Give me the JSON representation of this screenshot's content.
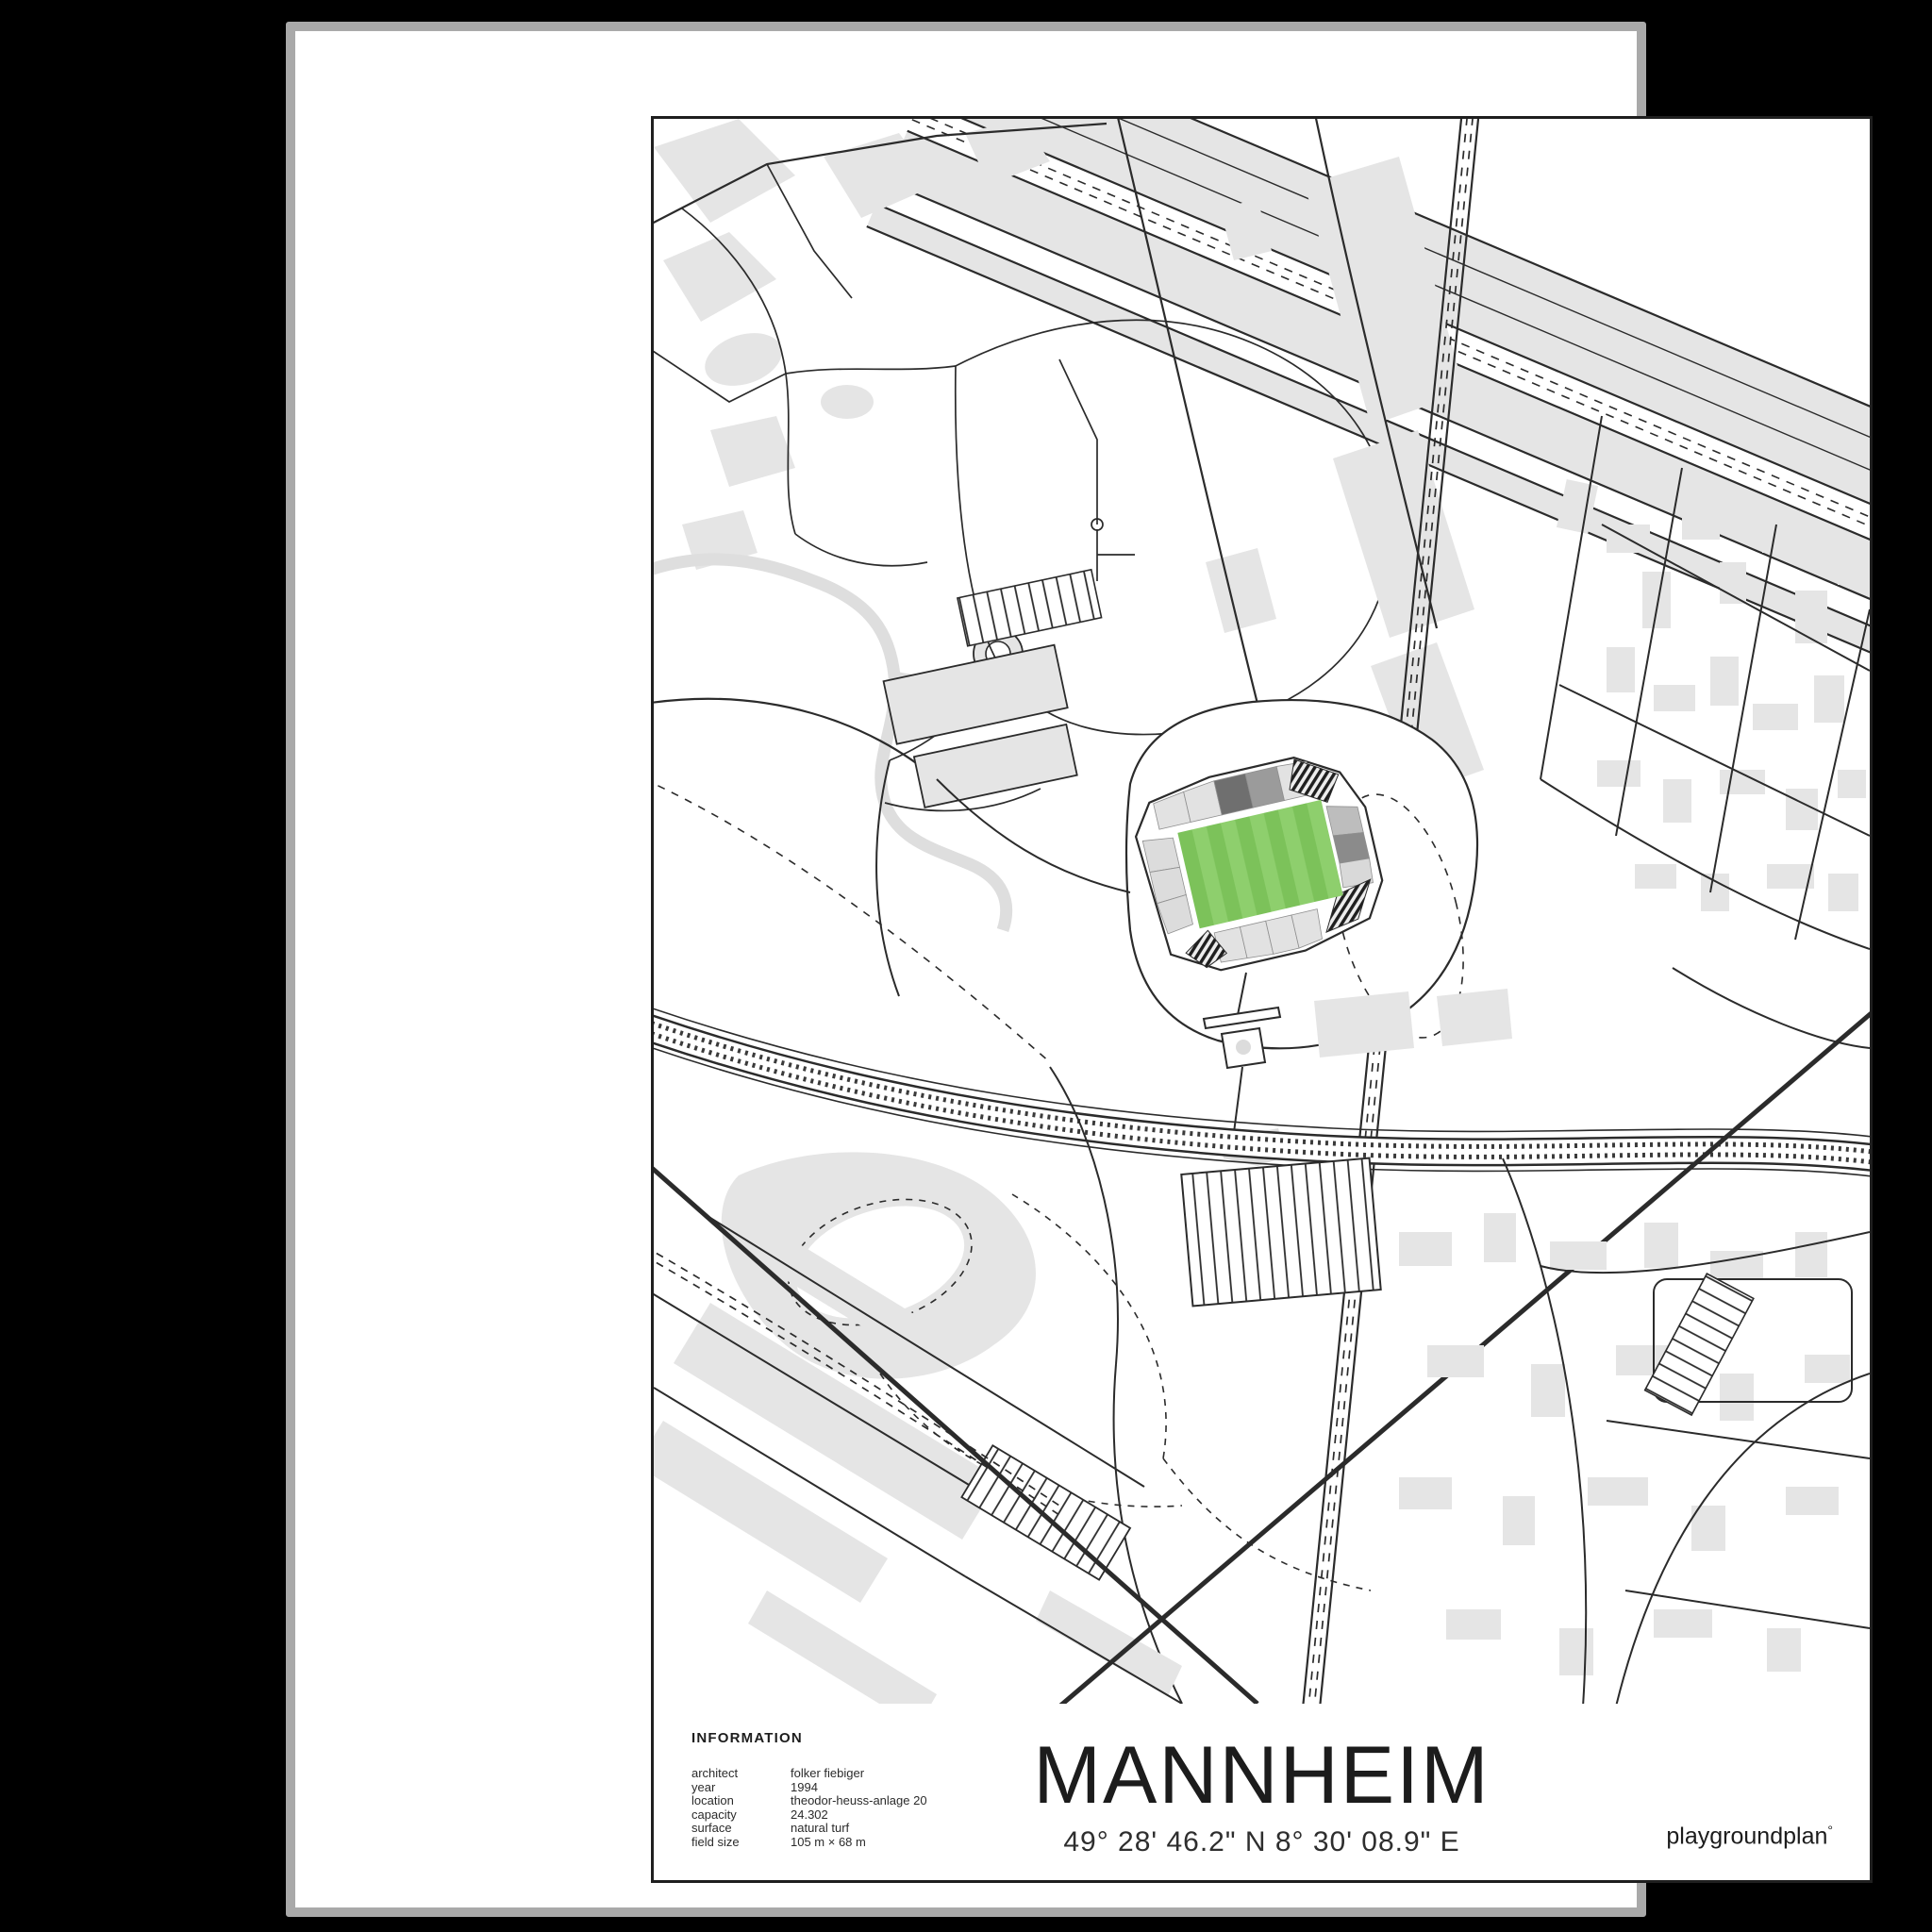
{
  "poster": {
    "title": "MANNHEIM",
    "coordinates": "49° 28' 46.2\" N 8° 30' 08.9\" E",
    "brand": {
      "name": "playgroundplan",
      "mark": "°"
    },
    "info": {
      "heading": "INFORMATION",
      "rows": [
        {
          "label": "architect",
          "value": "folker fiebiger"
        },
        {
          "label": "year",
          "value": "1994"
        },
        {
          "label": "location",
          "value": "theodor-heuss-anlage 20"
        },
        {
          "label": "capacity",
          "value": "24.302"
        },
        {
          "label": "surface",
          "value": "natural turf"
        },
        {
          "label": "field size",
          "value": "105 m × 68 m"
        }
      ]
    },
    "map": {
      "subject": "carl-benz-stadion-site-plan",
      "colors": {
        "pitch_stripe_light": "#8ecf6d",
        "pitch_stripe_dark": "#7cc25a",
        "building_gray": "#e5e5e5",
        "stream_gray": "#dedede",
        "line_black": "#2b2b2b",
        "frame_gray": "#a9a9a9",
        "paper_white": "#ffffff"
      }
    }
  }
}
